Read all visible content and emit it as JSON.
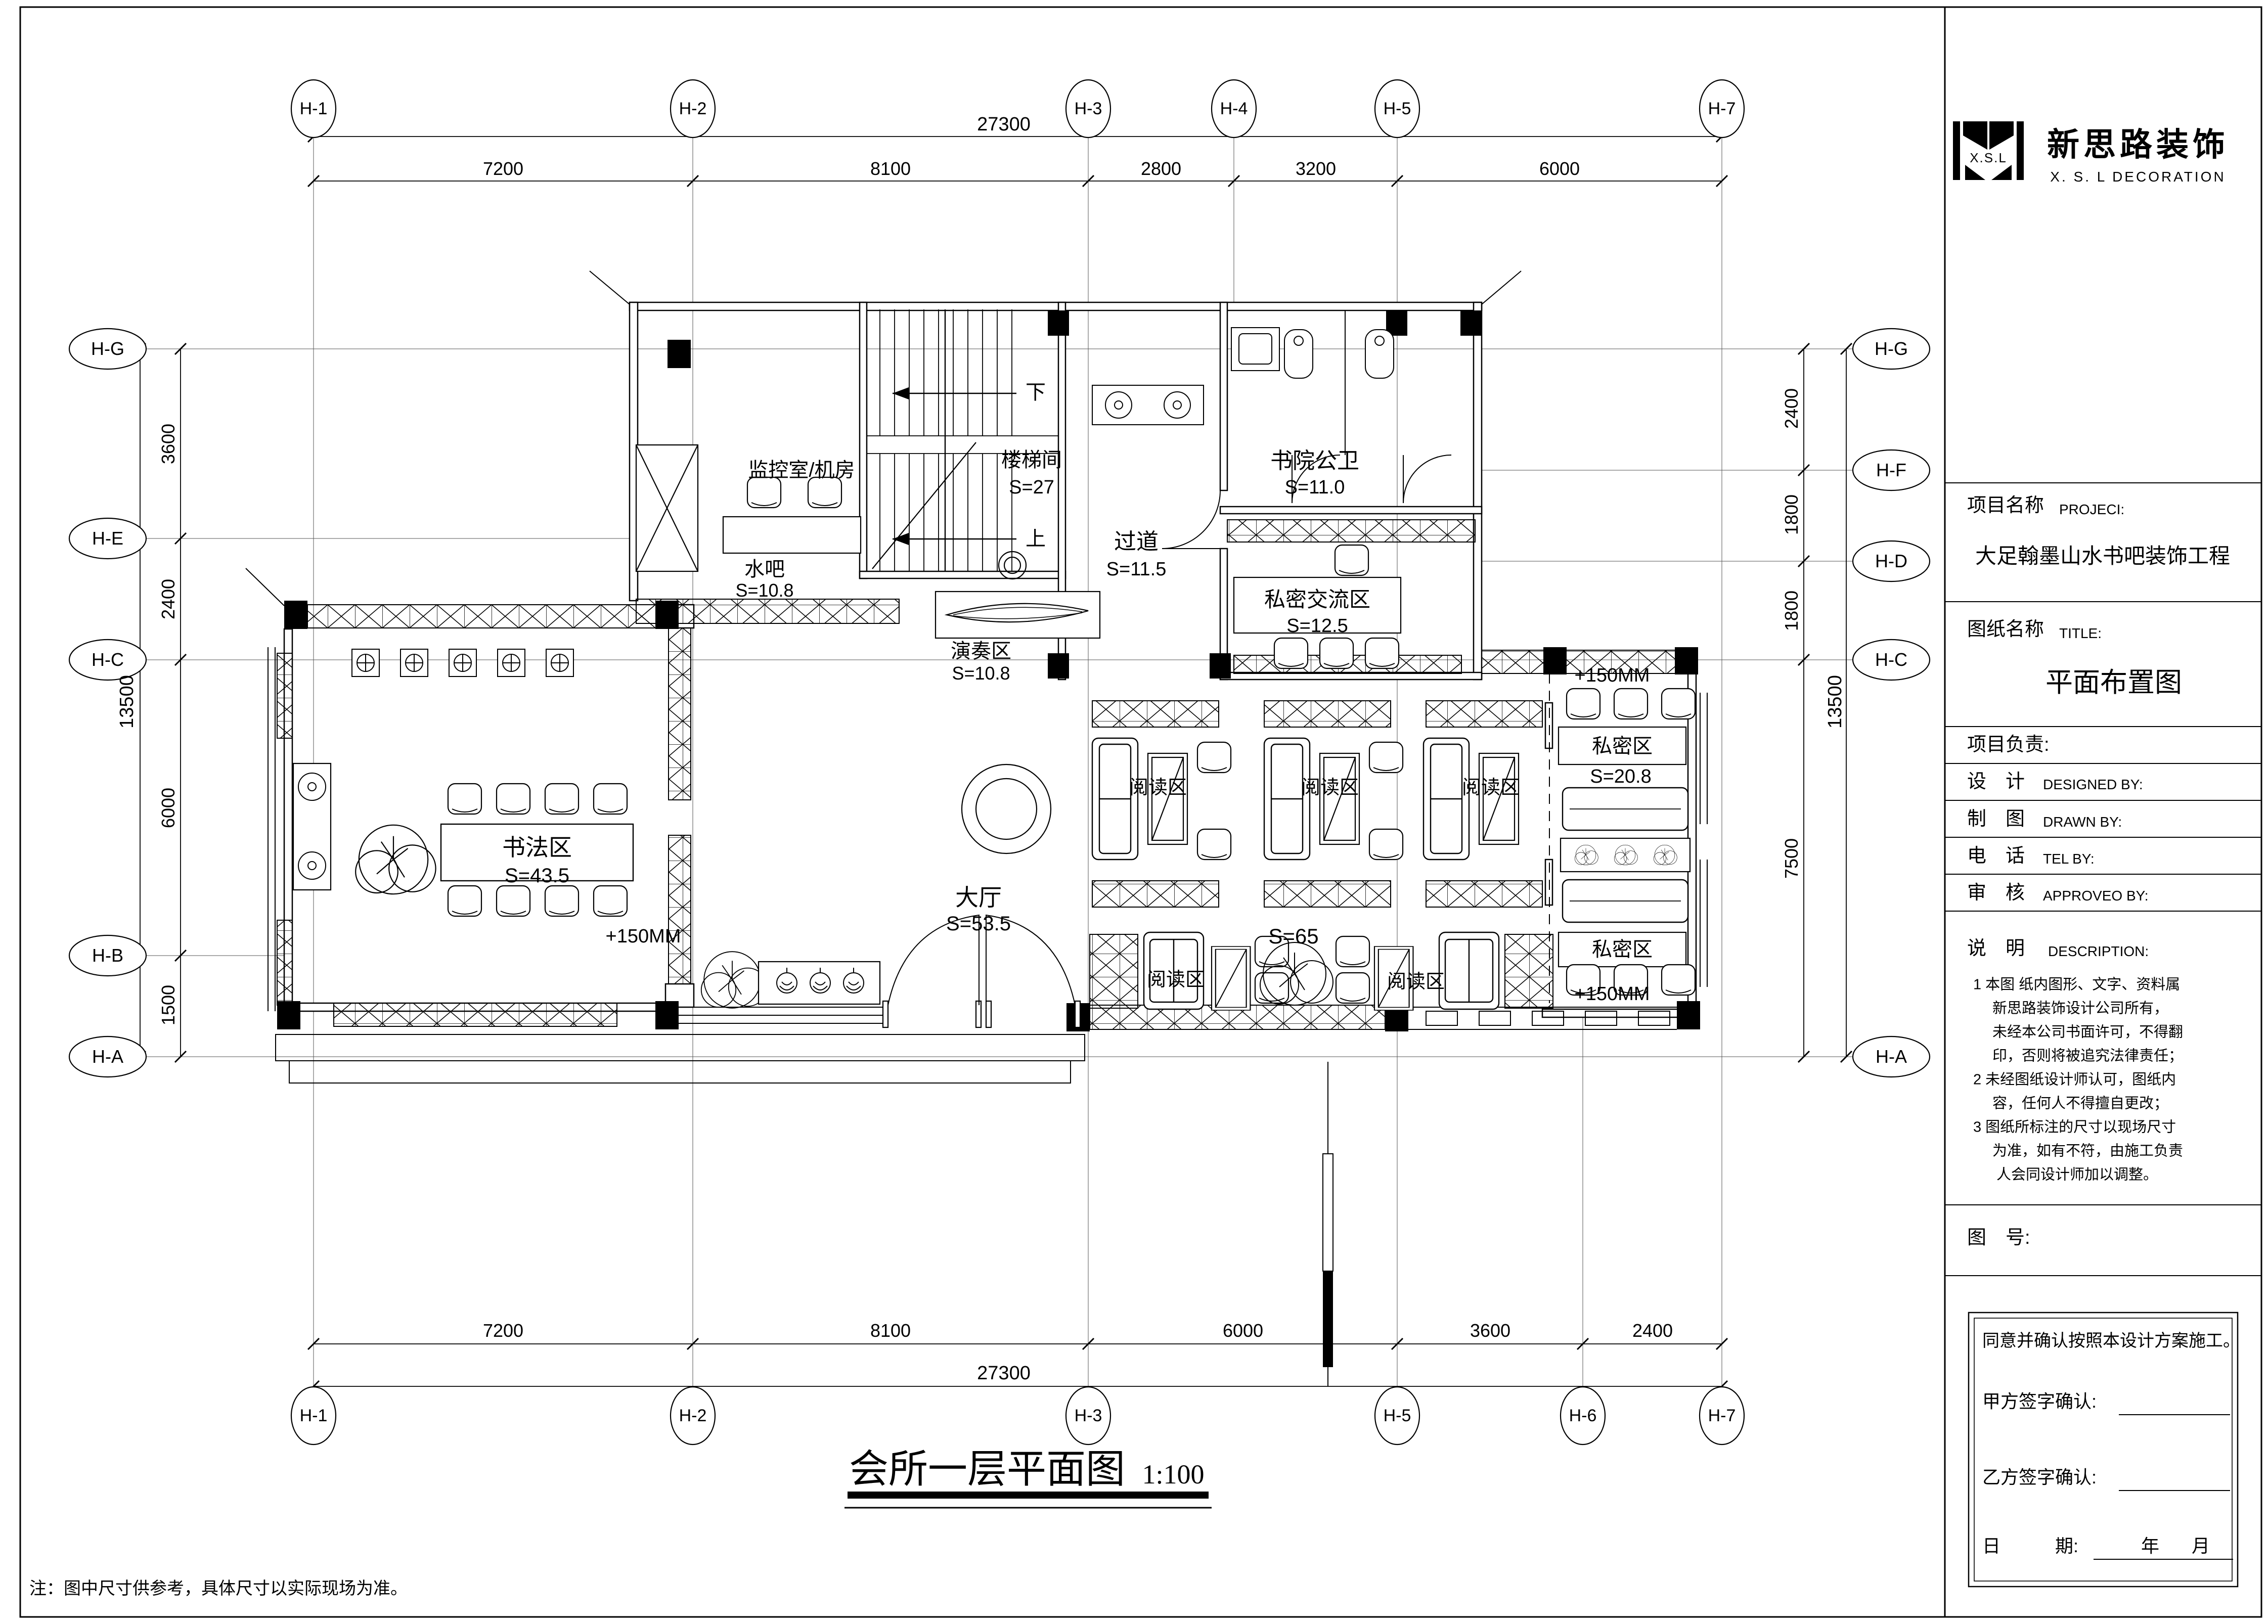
{
  "sheet": {
    "footnote": "注：图中尺寸供参考，具体尺寸以实际现场为准。",
    "plan_title": "会所一层平面图",
    "plan_scale": "1:100"
  },
  "logo": {
    "mark": "X.S.L",
    "cn": "新思路装饰",
    "en": "X. S. L  DECORATION"
  },
  "title_block": {
    "project_label": "项目名称",
    "project_label_en": "PROJECI:",
    "project_name": "大足翰墨山水书吧装饰工程",
    "drawing_label": "图纸名称",
    "drawing_label_en": "TITLE:",
    "drawing_name": "平面布置图",
    "pm_label": "项目负责:",
    "design_label": "设　计",
    "design_label_en": "DESIGNED BY:",
    "draft_label": "制　图",
    "draft_label_en": "DRAWN BY:",
    "tel_label": "电　话",
    "tel_label_en": "TEL BY:",
    "review_label": "审　核",
    "review_label_en": "APPROVEO BY:",
    "desc_label": "说　明",
    "desc_label_en": "DESCRIPTION:",
    "notes": [
      "1 本图 纸内图形、文字、资料属",
      "新思路装饰设计公司所有，",
      "未经本公司书面许可，不得翻",
      "印，否则将被追究法律责任；",
      "2 未经图纸设计师认可，图纸内",
      "容，任何人不得擅自更改；",
      "3 图纸所标注的尺寸以现场尺寸",
      "为准，如有不符，由施工负责",
      "人会同设计师加以调整。"
    ],
    "fig_label": "图　号:",
    "sig_statement": "同意并确认按照本设计方案施工。",
    "sig_party_a": "甲方签字确认:",
    "sig_party_b": "乙方签字确认:",
    "date_label": "日　　　期:",
    "date_year": "年",
    "date_month": "月"
  },
  "grid": {
    "top": [
      "H-1",
      "H-2",
      "H-3",
      "H-4",
      "H-5",
      "H-7"
    ],
    "bottom": [
      "H-1",
      "H-2",
      "H-3",
      "H-5",
      "H-6",
      "H-7"
    ],
    "left": [
      "H-G",
      "H-E",
      "H-C",
      "H-B",
      "H-A"
    ],
    "right": [
      "H-G",
      "H-F",
      "H-D",
      "H-C",
      "H-A"
    ]
  },
  "dims": {
    "top": {
      "total": "27300",
      "segs": [
        "7200",
        "8100",
        "2800",
        "3200",
        "6000"
      ]
    },
    "bottom": {
      "total": "27300",
      "segs": [
        "7200",
        "8100",
        "6000",
        "3600",
        "2400"
      ]
    },
    "left": {
      "total": "13500",
      "segs": [
        "3600",
        "2400",
        "6000",
        "1500"
      ]
    },
    "right": {
      "total": "13500",
      "segs": [
        "2400",
        "1800",
        "1800",
        "7500"
      ]
    }
  },
  "rooms": {
    "monitor": {
      "name": "监控室/机房"
    },
    "stair": {
      "name": "楼梯间",
      "area": "S=27"
    },
    "toilet": {
      "name": "书院公卫",
      "area": "S=11.0"
    },
    "corridor": {
      "name": "过道",
      "area": "S=11.5"
    },
    "private_meet": {
      "name": "私密交流区",
      "area": "S=12.5"
    },
    "waterbar": {
      "name": "水吧",
      "area": "S=10.8"
    },
    "stage": {
      "name": "演奏区",
      "area": "S=10.8"
    },
    "calligraphy": {
      "name": "书法区",
      "area": "S=43.5"
    },
    "hall": {
      "name": "大厅",
      "area": "S=53.5"
    },
    "hall_east": {
      "area": "S=65"
    },
    "private": {
      "name": "私密区",
      "area": "S=20.8"
    },
    "reading": {
      "name": "阅读区"
    }
  },
  "annotations": {
    "up": "上",
    "down": "下",
    "plus150": "+150MM"
  }
}
